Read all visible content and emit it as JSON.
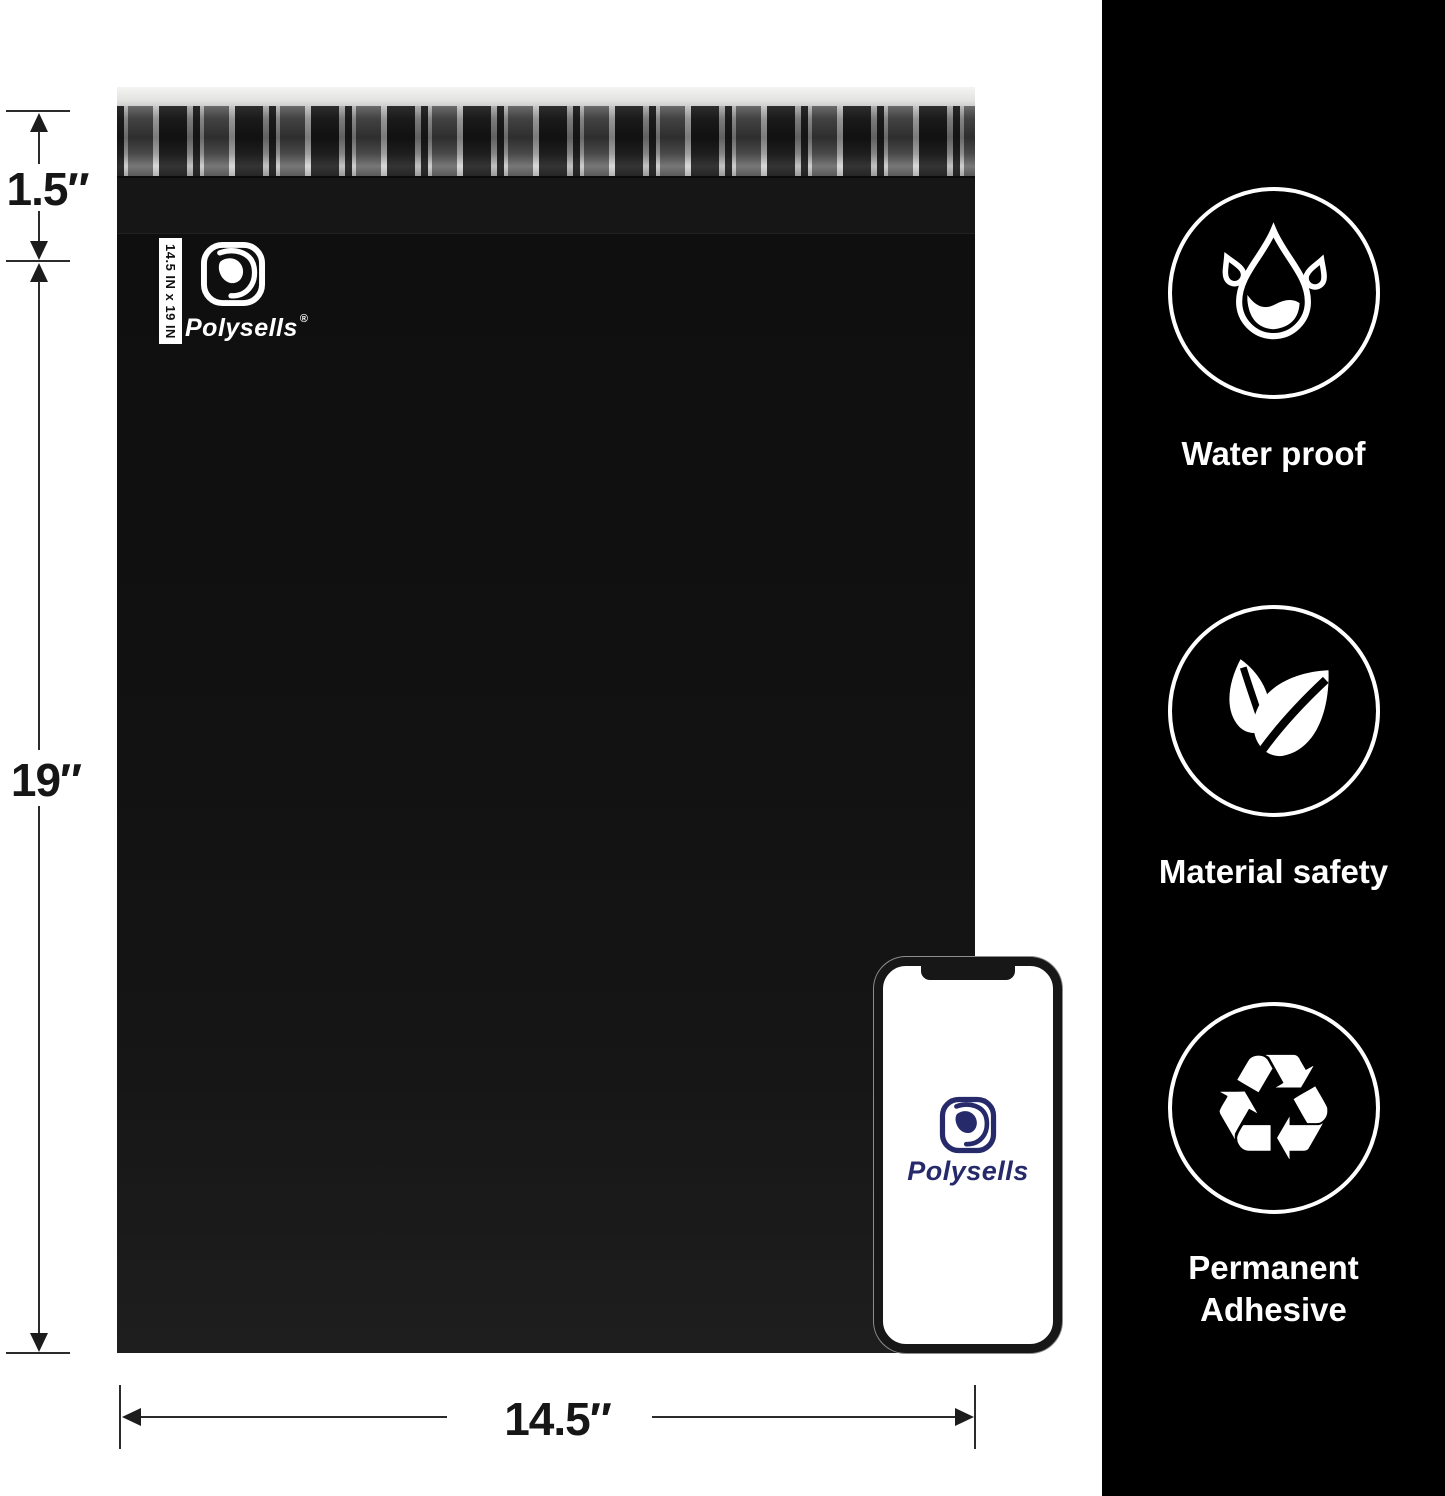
{
  "annotations": {
    "flap_height": "1.5″",
    "bag_height": "19″",
    "bag_width": "14.5″"
  },
  "bag": {
    "size_tag": "14.5 IN x 19 IN",
    "brand": "Polysells",
    "registered_mark": "®"
  },
  "phone": {
    "brand": "Polysells"
  },
  "sidebar": {
    "features": [
      {
        "icon": "water-drop-icon",
        "label": "Water proof"
      },
      {
        "icon": "leaves-icon",
        "label": "Material safety"
      },
      {
        "icon": "recycle-icon",
        "label": "Permanent Adhesive"
      }
    ],
    "recycle_glyph": "♻"
  },
  "colors": {
    "sidebar_bg": "#000000",
    "bag_body": "#111111",
    "brand_navy": "#262a6b",
    "dimension_ink": "#1c1c1c"
  }
}
